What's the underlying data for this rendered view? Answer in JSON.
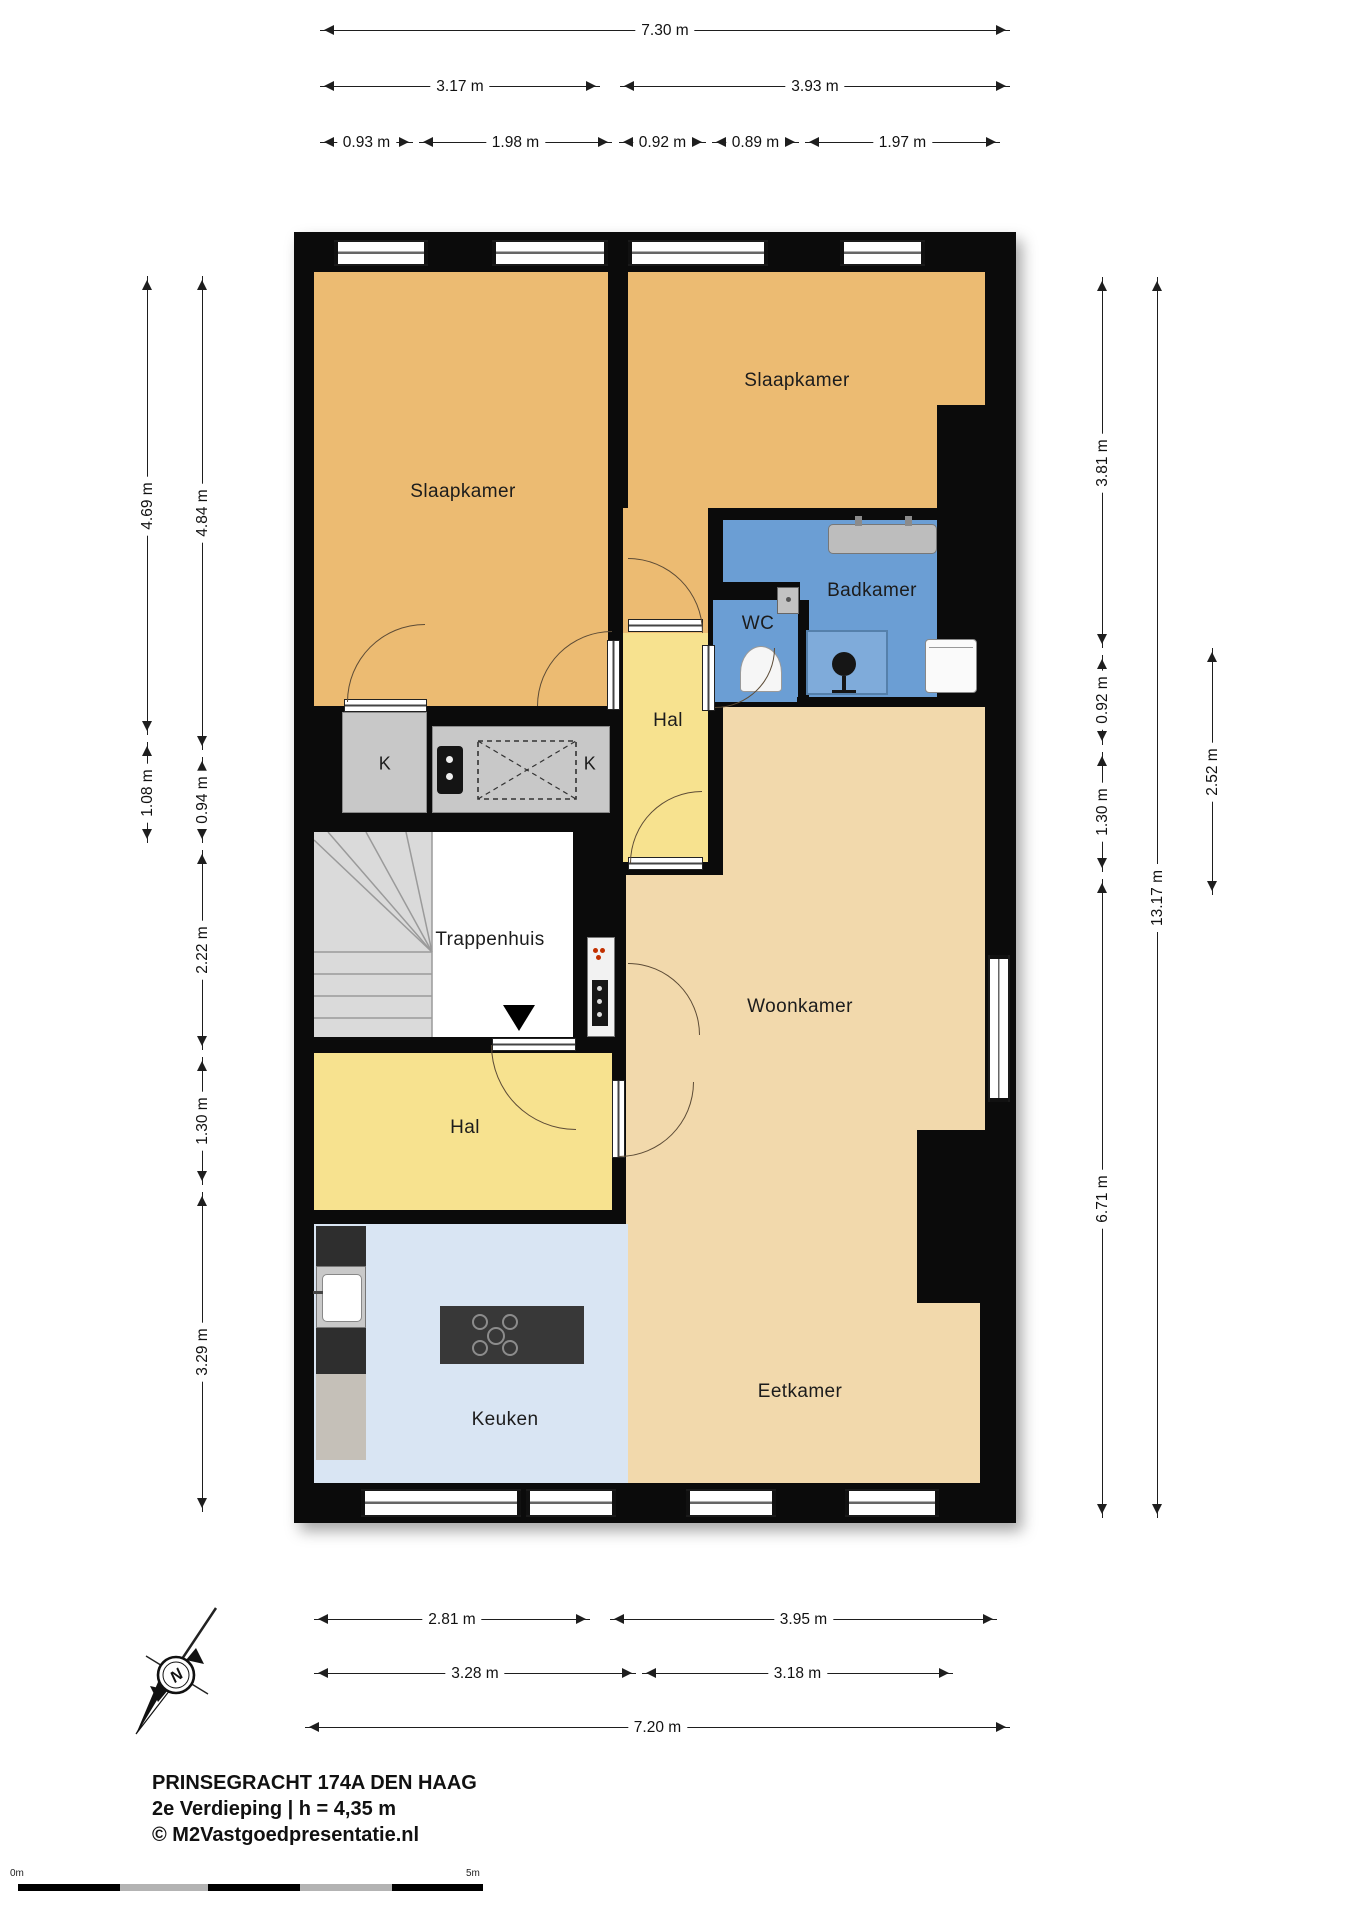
{
  "title": {
    "line1": "PRINSEGRACHT 174A DEN HAAG",
    "line2": "2e Verdieping | h = 4,35 m",
    "line3": "© M2Vastgoedpresentatie.nl"
  },
  "rooms": {
    "slaapkamer_left": "Slaapkamer",
    "slaapkamer_right": "Slaapkamer",
    "hal_upper": "Hal",
    "badkamer": "Badkamer",
    "wc": "WC",
    "trappenhuis": "Trappenhuis",
    "woonkamer": "Woonkamer",
    "hal_lower": "Hal",
    "keuken": "Keuken",
    "eetkamer": "Eetkamer",
    "kast_left": "K",
    "kast_counter": "K"
  },
  "dims": {
    "top_total": "7.30 m",
    "top_a": "3.17 m",
    "top_b": "3.93 m",
    "top_c1": "0.93 m",
    "top_c2": "1.98 m",
    "top_c3": "0.92 m",
    "top_c4": "0.89 m",
    "top_c5": "1.97 m",
    "left_outer1": "4.69 m",
    "left_outer2": "1.08 m",
    "left_inner1": "4.84 m",
    "left_inner2": "0.94 m",
    "left_inner3": "2.22 m",
    "left_inner4": "1.30 m",
    "left_inner5": "3.29 m",
    "right_a": "3.81 m",
    "right_b": "0.92 m",
    "right_c": "1.30 m",
    "right_d": "6.71 m",
    "right_total": "13.17 m",
    "right_e": "2.52 m",
    "bottom_a": "2.81 m",
    "bottom_b": "3.95 m",
    "bottom_c": "3.28 m",
    "bottom_d": "3.18 m",
    "bottom_total": "7.20 m"
  },
  "compass": {
    "north_label": "N"
  },
  "scale_bar": {
    "zero_label": "0m",
    "five_label": "5m"
  },
  "colors": {
    "wall": "#0b0b0b",
    "bedroom": "#ecbb72",
    "living": "#f2d9ac",
    "hall": "#f7e28f",
    "bath": "#6b9ed4",
    "shower": "#7fabda",
    "kitchen": "#d9e5f3",
    "closet": "#c8c8c8",
    "stairs": "#ffffff"
  }
}
